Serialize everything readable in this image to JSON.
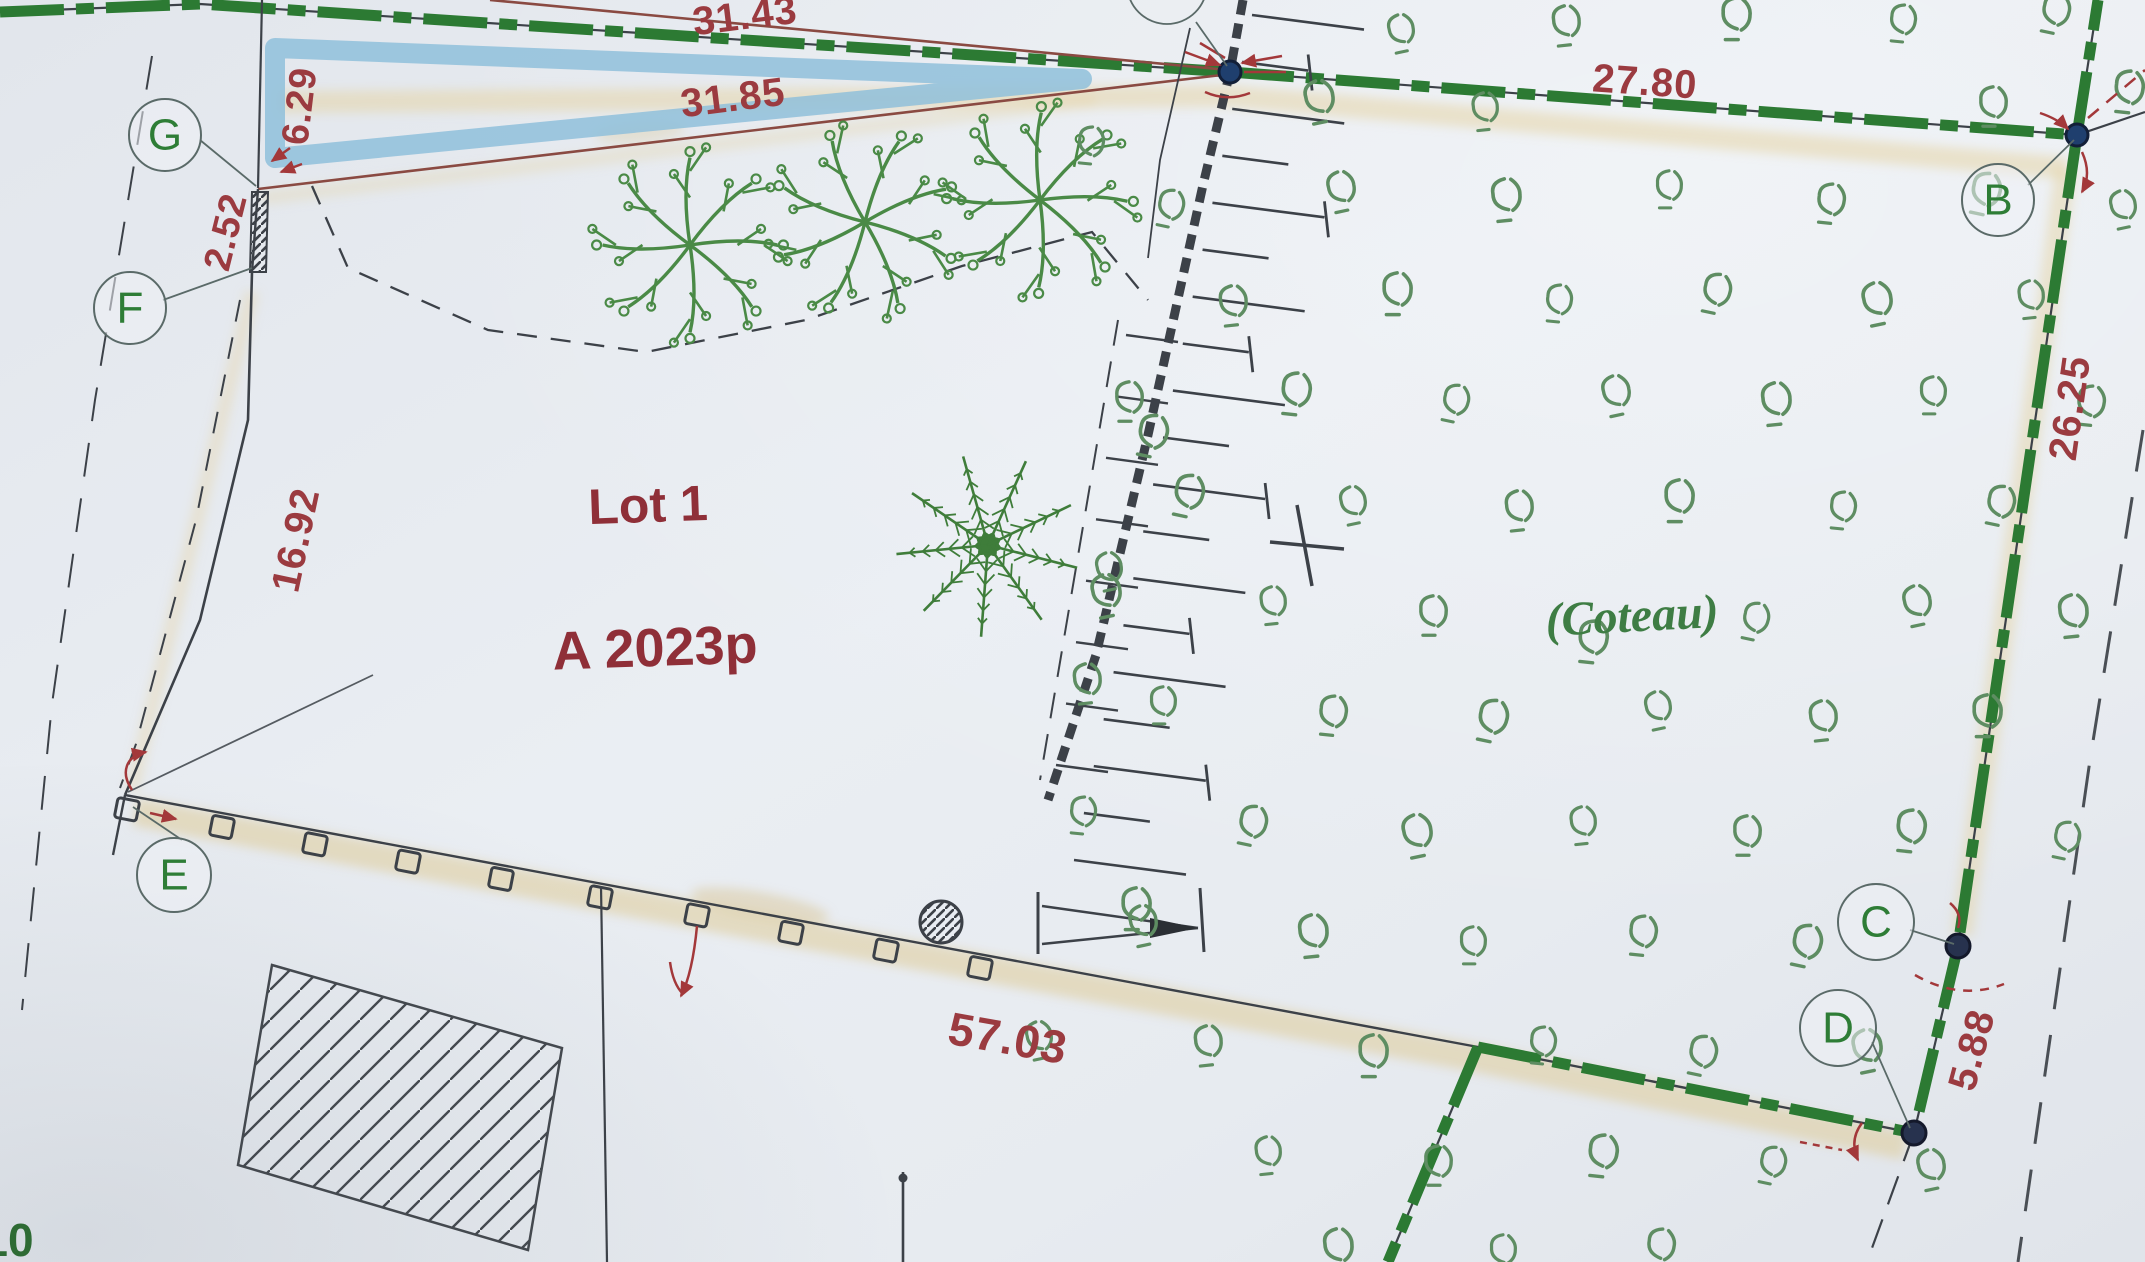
{
  "plan": {
    "lot": {
      "name": "Lot 1",
      "ref": "A 2023p"
    },
    "area_label": "(Coteau)",
    "corner_number": "10",
    "points": {
      "B": "B",
      "C": "C",
      "D": "D",
      "E": "E",
      "F": "F",
      "G": "G"
    },
    "measurements": {
      "top_left": "31.43",
      "top_inner": "31.85",
      "top_right": "27.80",
      "g_offset": "6.29",
      "g_strip": "2.52",
      "west": "16.92",
      "east": "26.25",
      "south": "57.03",
      "cd": "5.88"
    },
    "colors": {
      "boundary_green": "#2c7a33",
      "dimension_red": "#9b3b40",
      "line_red": "#8a4a42",
      "vine_green": "#5e8d62",
      "tree_green": "#4a8a46",
      "conifer_green": "#3f7d3a",
      "water_blue": "#8fc0da",
      "paper": "#e8ecf1",
      "ink": "#3c4148",
      "label_green": "#2e7d36",
      "highlight_tan": "#e6d7ae"
    }
  }
}
